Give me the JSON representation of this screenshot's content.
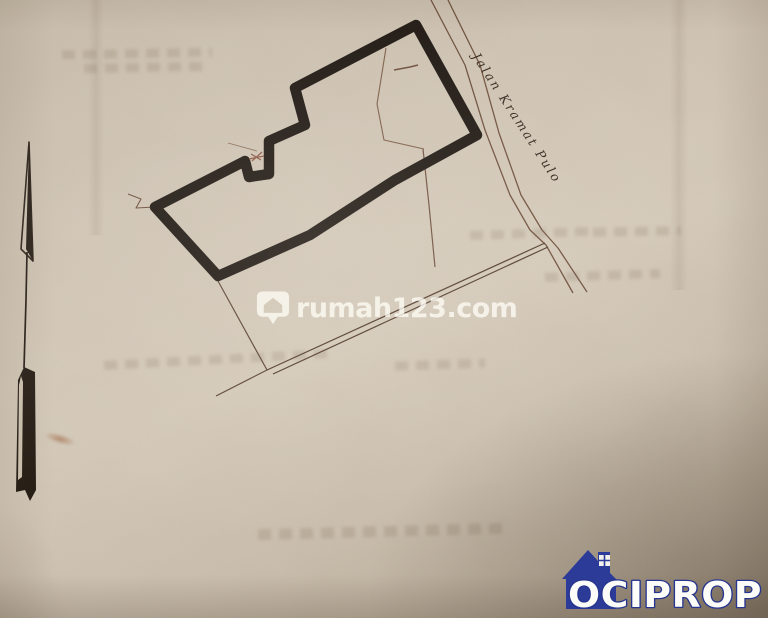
{
  "road_label": {
    "text": "Jalan Kramat Pulo"
  },
  "watermark": {
    "text": "rumah123.com",
    "icon": "location-pin-house-icon"
  },
  "logo": {
    "text": "OCIPROP",
    "icon": "house-icon"
  },
  "north_arrow": {
    "icon": "north-arrow-icon"
  },
  "colors": {
    "paper": "#cfc4b3",
    "paper_dark_corner": "#a99c8a",
    "plot_boundary": "#1e1711",
    "cadastral_line": "#6e4e3b",
    "road_label_text": "#33261c",
    "watermark_white": "rgba(255,253,247,0.75)",
    "logo_blue": "#2b3b97",
    "logo_text_fill": "#fcfcf8",
    "x_marker": "#8e5744"
  },
  "geometry": {
    "plot_boundary_points": "416,25 477,135 395,180 310,235 218,276 155,207 245,161 249,177 269,174 269,141 305,125 295,88",
    "thin_lines": [
      {
        "name": "road-edge-west",
        "points": "431,0 465,65 485,130 510,195 530,230 546,245 573,293",
        "width": 1.3,
        "color": "#6e4e3b"
      },
      {
        "name": "road-edge-east",
        "points": "448,0 480,65 499,133 521,195 542,230 558,248 587,292",
        "width": 1.3,
        "color": "#6e4e3b"
      },
      {
        "name": "parcel-line-a",
        "points": "267,370 545,243",
        "width": 1.2,
        "color": "#503a2b"
      },
      {
        "name": "parcel-line-b",
        "points": "273,374 548,247",
        "width": 1.2,
        "color": "#503a2b"
      },
      {
        "name": "parcel-branch-west",
        "points": "218,281 267,370 216,396",
        "width": 1.2,
        "color": "#5a4233"
      },
      {
        "name": "parcel-line-south",
        "points": "423,149 429,205 435,267",
        "width": 1.2,
        "color": "#6e4e3b"
      },
      {
        "name": "parcel-line-inner",
        "points": "386,48 377,104 384,140 424,149",
        "width": 1.1,
        "color": "#7c5c45"
      },
      {
        "name": "survey-tick",
        "points": "394,70 410,67 418,65",
        "width": 1.5,
        "color": "#6e4e3b"
      },
      {
        "name": "pencil-line-notch",
        "points": "228,143 257,151",
        "width": 0.9,
        "color": "#8a6a52"
      },
      {
        "name": "zigzag-west",
        "points": "128,194 141,199 136,208 155,207",
        "width": 1.1,
        "color": "#6e4e3b"
      }
    ],
    "north_arrow": {
      "head_outline": "29,142 21,249 33,261",
      "head_fill": "29,142 33,261 26,249",
      "shaft": "27,252 26,300 24,368",
      "tail_fill": "24,367 35,372 36,490 30,501 25,490 16,492 18,380",
      "tail_inner": "21,376 19,385 18,480 22,477 23,382"
    },
    "x_marker": [
      "252,161 262,152",
      "251,154 261,160",
      "249,159 264,156"
    ]
  }
}
